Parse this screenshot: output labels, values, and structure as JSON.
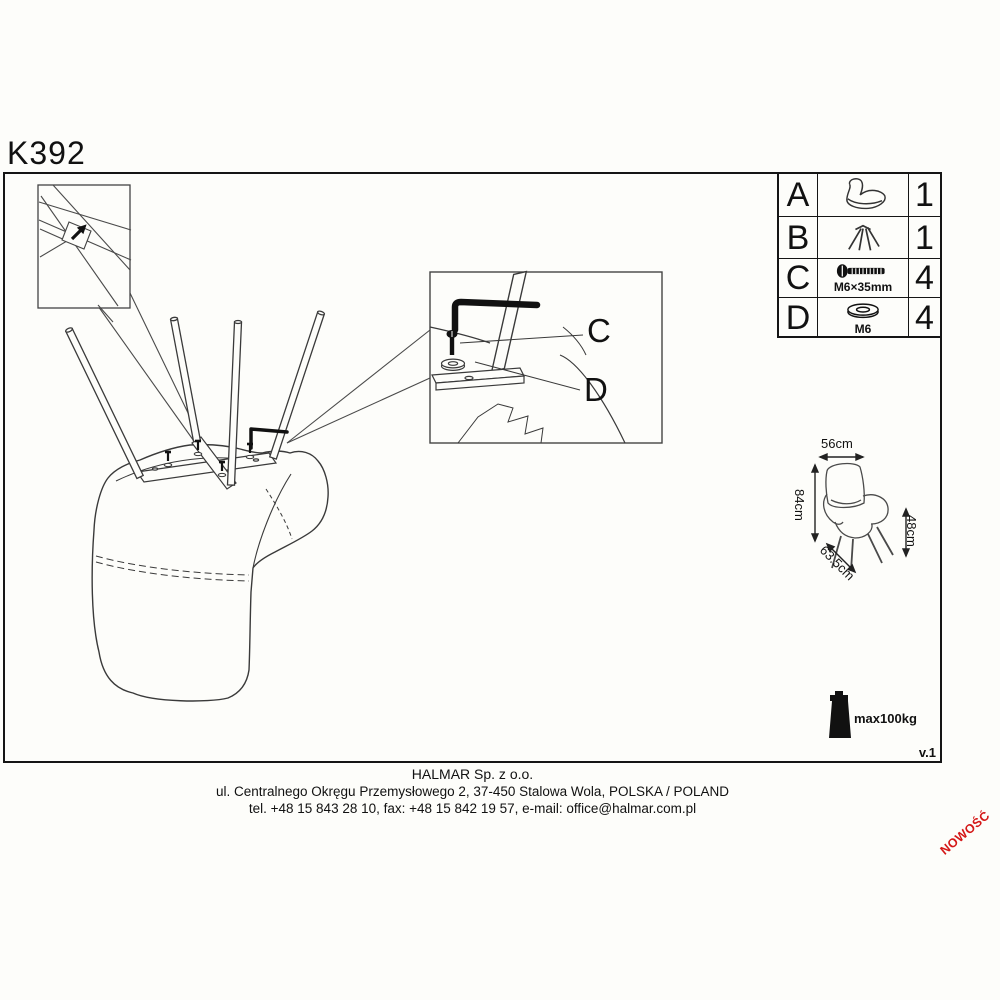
{
  "page": {
    "title": "K392",
    "version": "v.1",
    "new_badge": "NOWOŚĆ"
  },
  "parts_table": {
    "rows": [
      {
        "letter": "A",
        "qty": "1"
      },
      {
        "letter": "B",
        "qty": "1"
      },
      {
        "letter": "C",
        "spec": "M6×35mm",
        "qty": "4"
      },
      {
        "letter": "D",
        "spec": "M6",
        "qty": "4"
      }
    ]
  },
  "diagram": {
    "labels": {
      "bolt": "C",
      "washer": "D"
    }
  },
  "dimensions": {
    "width": "56cm",
    "height": "84cm",
    "seat_height": "48cm",
    "depth": "63.5cm"
  },
  "load": {
    "max": "max100kg"
  },
  "footer": {
    "company": "HALMAR Sp. z o.o.",
    "address": "ul. Centralnego Okręgu Przemysłowego 2, 37-450 Stalowa Wola, POLSKA / POLAND",
    "contact": "tel. +48 15 843 28 10, fax: +48 15 842 19 57, e-mail: office@halmar.com.pl"
  },
  "colors": {
    "badge_red": "#d41717",
    "ink": "#151515"
  }
}
